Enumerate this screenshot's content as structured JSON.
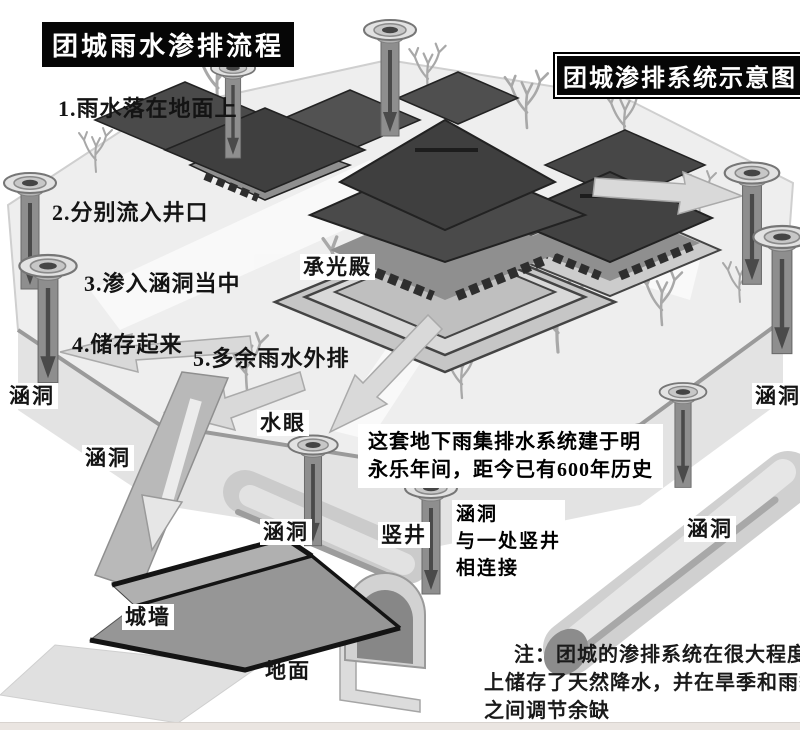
{
  "titles": {
    "flow": "团城雨水渗排流程",
    "diagram": "团城渗排系统示意图"
  },
  "steps": [
    "1.雨水落在地面上",
    "2.分别流入井口",
    "3.渗入涵洞当中",
    "4.储存起来",
    "5.多余雨水外排"
  ],
  "labels": {
    "hall": "承光殿",
    "water_eye": "水眼",
    "culvert": "涵洞",
    "shaft": "竖井",
    "wall": "城墙",
    "ground": "地面"
  },
  "notes": {
    "history_l1": "这套地下雨集排水系统建于明",
    "history_l2": "永乐年间，距今已有600年历史",
    "connect_l1": "涵洞",
    "connect_l2": "与一处竖井",
    "connect_l3": "相连接",
    "note_l1": "注：团城的渗排系统在很大程度",
    "note_l2": "上储存了天然降水，并在旱季和雨季",
    "note_l3": "之间调节余缺"
  },
  "colors": {
    "title_bg": "#000000",
    "title_fg": "#ffffff",
    "text": "#141414",
    "label_bg": "#ffffff",
    "roof": "#454545",
    "stone": "#a9a9a9",
    "platform": "#ededed",
    "arrow": "#d9d9d9"
  }
}
